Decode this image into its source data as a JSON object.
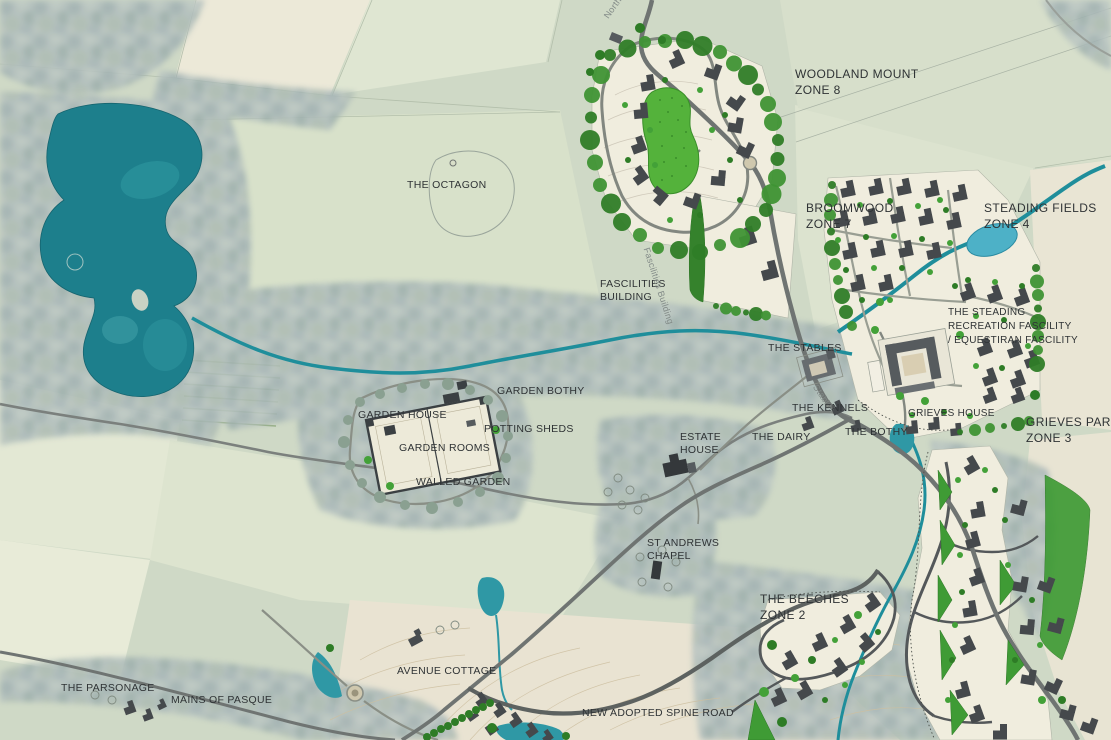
{
  "labels": {
    "north_lodge": {
      "text": "North Lodge"
    },
    "woodland_mount": {
      "line1": "WOODLAND MOUNT",
      "line2": "ZONE 8"
    },
    "the_octagon": {
      "text": "THE OCTAGON"
    },
    "broomwood": {
      "line1": "BROOMWOOD",
      "line2": "ZONE 7"
    },
    "steading_fields": {
      "line1": "STEADING FIELDS",
      "line2": "ZONE 4"
    },
    "fascilities_building": {
      "line1": "FASCILITIES",
      "line2": "BUILDING"
    },
    "fascilities_road": {
      "text": "Fascilities Building"
    },
    "the_steading": {
      "line1": "THE STEADING",
      "line2": "RECREATION FASCILITY",
      "line3": "/ EQUESTIRAN FASCILITY"
    },
    "the_stables": {
      "text": "THE STABLES"
    },
    "stables_drive": {
      "text": "Stables"
    },
    "the_kennels": {
      "text": "THE KENNELS"
    },
    "grieves_house": {
      "text": "GRIEVES HOUSE"
    },
    "grieves_park": {
      "line1": "GRIEVES PARK",
      "line2": "ZONE 3"
    },
    "garden_bothy": {
      "text": "GARDEN BOTHY"
    },
    "garden_house": {
      "text": "GARDEN HOUSE"
    },
    "potting_sheds": {
      "text": "POTTING SHEDS"
    },
    "garden_rooms": {
      "text": "GARDEN ROOMS"
    },
    "walled_garden": {
      "text": "WALLED GARDEN"
    },
    "estate_house": {
      "line1": "ESTATE",
      "line2": "HOUSE"
    },
    "the_dairy": {
      "text": "THE DAIRY"
    },
    "the_bothy": {
      "text": "THE BOTHY"
    },
    "st_andrews_chapel": {
      "line1": "ST ANDREWS",
      "line2": "CHAPEL"
    },
    "the_beeches": {
      "line1": "THE BEECHES",
      "line2": "ZONE 2"
    },
    "the_parsonage": {
      "text": "THE PARSONAGE"
    },
    "mains_of_pasque": {
      "text": "MAINS OF PASQUE"
    },
    "avenue_cottage": {
      "text": "AVENUE COTTAGE"
    },
    "new_adopted_spine_road": {
      "text": "NEW ADOPTED SPINE ROAD"
    }
  },
  "zones": [
    {
      "zone": "ZONE 8",
      "name": "WOODLAND MOUNT"
    },
    {
      "zone": "ZONE 7",
      "name": "BROOMWOOD"
    },
    {
      "zone": "ZONE 4",
      "name": "STEADING FIELDS"
    },
    {
      "zone": "ZONE 3",
      "name": "GRIEVES PARK"
    },
    {
      "zone": "ZONE 2",
      "name": "THE BEECHES"
    }
  ],
  "colors": {
    "lake": "#1d7f8c",
    "stream": "#1f8e9b",
    "pond": "#4db1c7",
    "field_sage": "#cfd9c6",
    "field_cream": "#ece9d8",
    "field_tan": "#e9e3d2",
    "woodland": "#aebbbb",
    "tree_bright": "#43a138",
    "tree_dark": "#2e7c26",
    "plot_cream": "#f0edde",
    "road_gray": "#6f7472",
    "building_gray": "#45494c",
    "label_text": "#2f3335"
  }
}
